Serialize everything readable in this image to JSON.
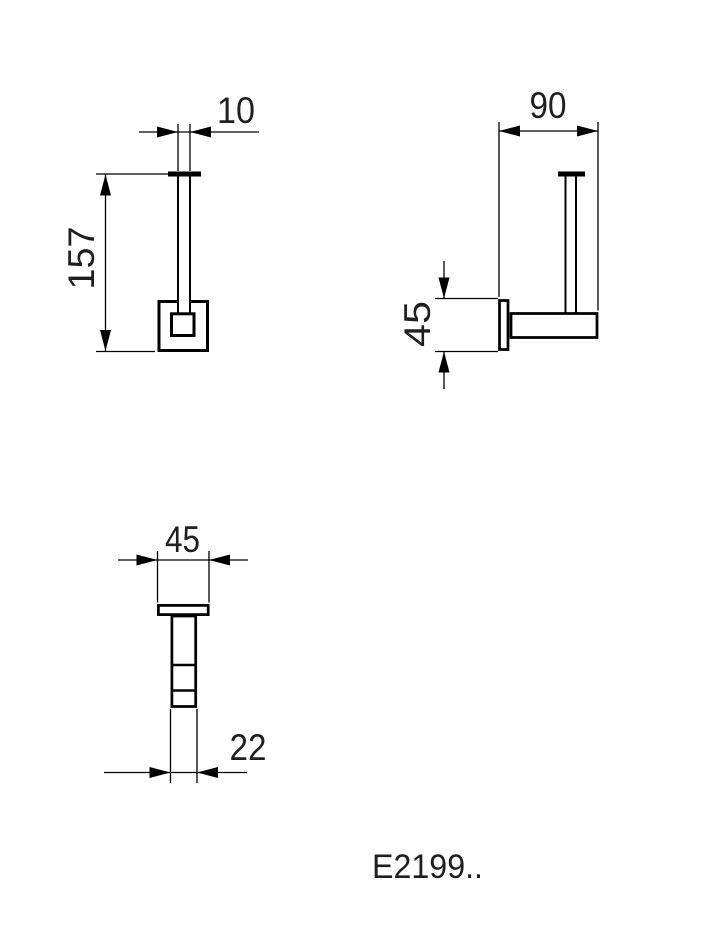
{
  "product_code": "E2199..",
  "dimensions": {
    "front": {
      "rod_diameter": "10",
      "height": "157"
    },
    "side": {
      "depth": "90",
      "plate_height": "45"
    },
    "plan": {
      "plate_width": "45",
      "arm_width": "22"
    }
  },
  "colors": {
    "line": "#000000",
    "text": "#1f1f1f",
    "background": "#ffffff"
  }
}
